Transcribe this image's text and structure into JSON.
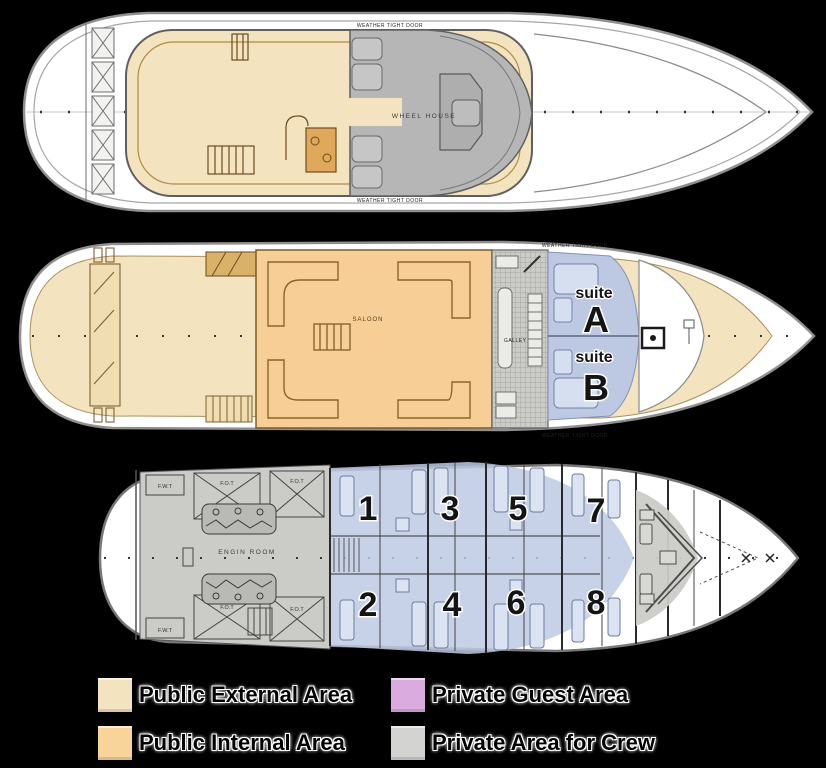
{
  "decks": {
    "top": {
      "wheelhouse_label": "WHEEL HOUSE",
      "door_top_label": "WEATHER TIGHT DOOR",
      "door_bottom_label": "WEATHER TIGHT DOOR"
    },
    "main": {
      "saloon_label": "SALOON",
      "galley_label": "GALLEY",
      "door_top_label": "WEATHER TIGHT DOOR",
      "door_bottom_label": "WEATHER TIGHT DOOR",
      "suite_a_prefix": "suite",
      "suite_a_letter": "A",
      "suite_b_prefix": "suite",
      "suite_b_letter": "B"
    },
    "lower": {
      "engine_room_label": "ENGIN ROOM",
      "tank_labels": [
        "F.W.T",
        "F.O.T",
        "F.O.T",
        "F.W.T",
        "F.O.T",
        "F.O.T"
      ],
      "cabin_numbers": [
        "1",
        "2",
        "3",
        "4",
        "5",
        "6",
        "7",
        "8"
      ]
    }
  },
  "legend": {
    "items": [
      {
        "label": "Public External Area",
        "color": "#f3e3bf"
      },
      {
        "label": "Private Guest Area",
        "color": "#d9abdf"
      },
      {
        "label": "Public Internal Area",
        "color": "#f8d49a"
      },
      {
        "label": "Private Area for Crew",
        "color": "#d3d3d1"
      }
    ]
  },
  "colors": {
    "background": "#000000",
    "public_external": "#f3e3bf",
    "public_internal": "#f7cf96",
    "private_guest_plan": "#bdc9e3",
    "crew_dark": "#b6b6b6",
    "crew_light": "#cbcbc7"
  }
}
